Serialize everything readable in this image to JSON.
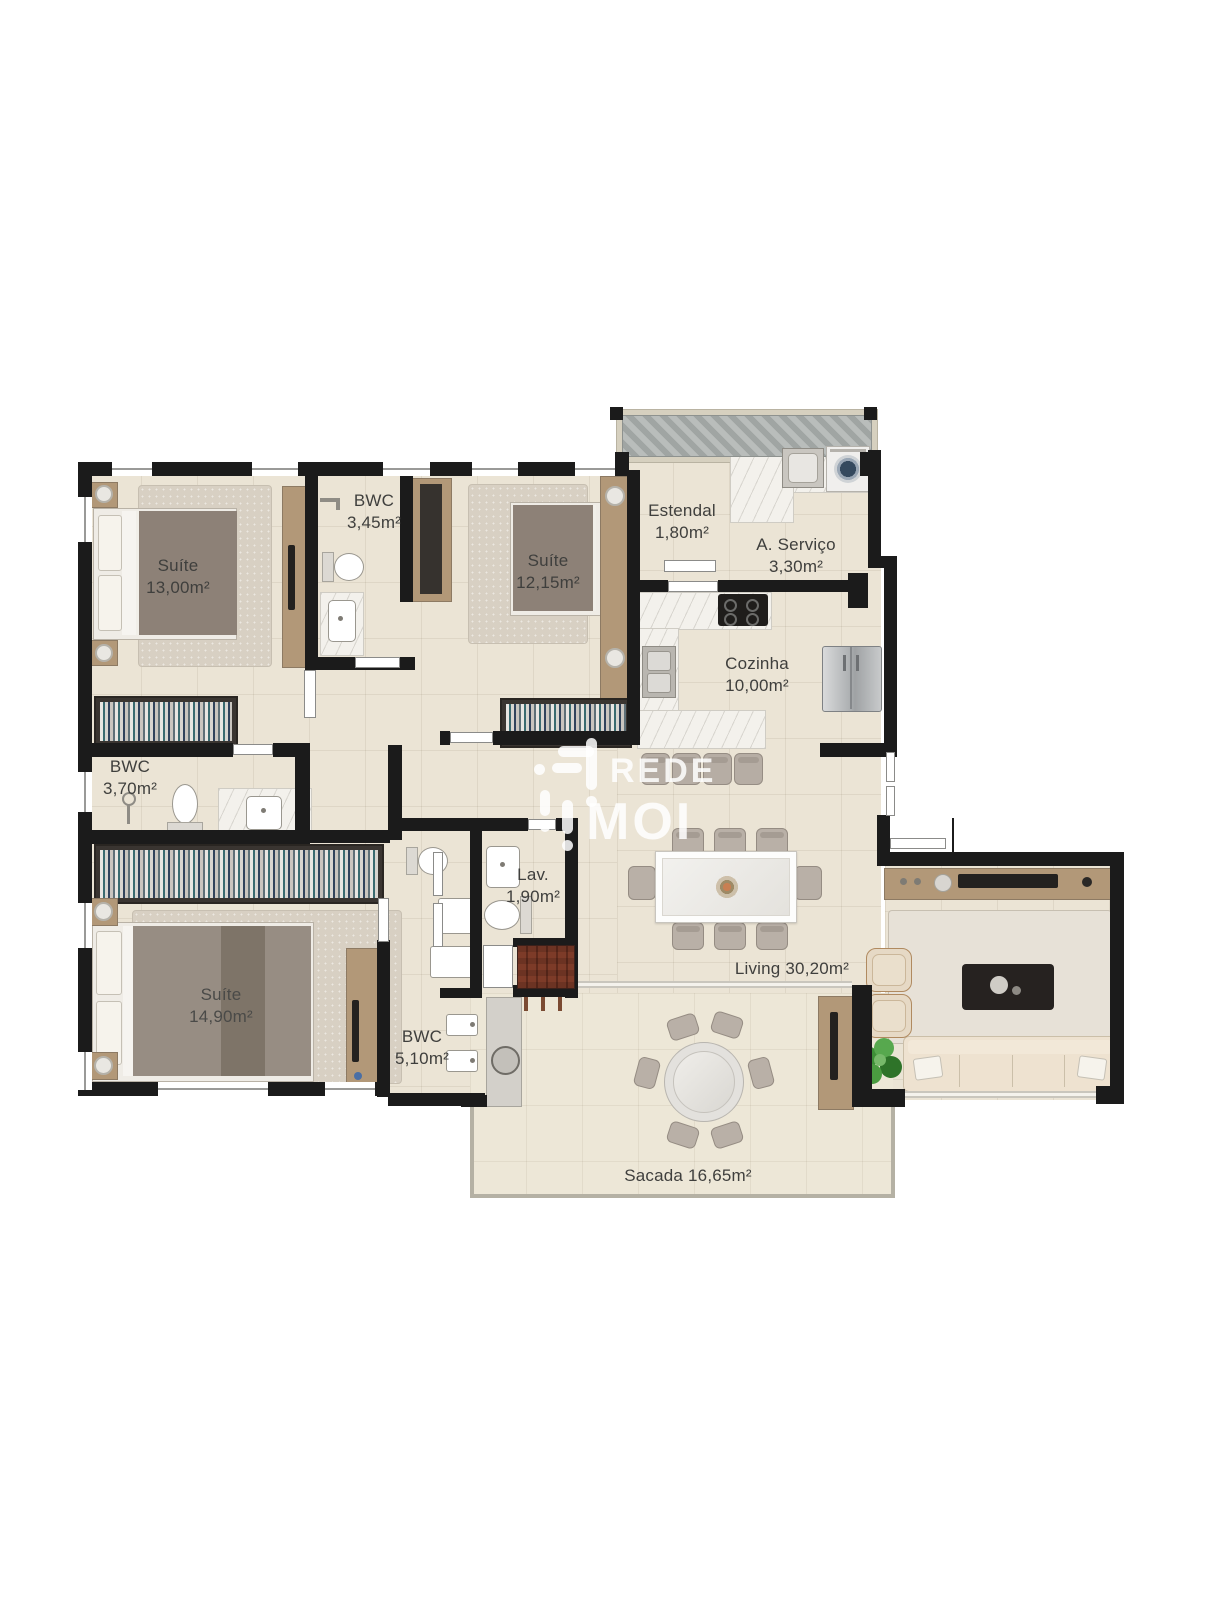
{
  "watermark": {
    "brand_line1": "REDE",
    "brand_line2": "MOI"
  },
  "rooms": {
    "suite_13": {
      "name": "Suíte",
      "area": "13,00m²"
    },
    "bwc_345": {
      "name": "BWC",
      "area": "3,45m²"
    },
    "suite_1215": {
      "name": "Suíte",
      "area": "12,15m²"
    },
    "estendal": {
      "name": "Estendal",
      "area": "1,80m²"
    },
    "servico": {
      "name": "A. Serviço",
      "area": "3,30m²"
    },
    "cozinha": {
      "name": "Cozinha",
      "area": "10,00m²"
    },
    "bwc_370": {
      "name": "BWC",
      "area": "3,70m²"
    },
    "lav": {
      "name": "Lav.",
      "area": "1,90m²"
    },
    "suite_1490": {
      "name": "Suíte",
      "area": "14,90m²"
    },
    "bwc_510": {
      "name": "BWC",
      "area": "5,10m²"
    },
    "living": {
      "label": "Living 30,20m²"
    },
    "sacada": {
      "label": "Sacada 16,65m²"
    }
  },
  "colors": {
    "wall": "#1b1b1b",
    "floor": "#ebe4d5",
    "wood": "#b29878",
    "marble": "#f3f1ec",
    "label_text": "#3f3f3d"
  }
}
